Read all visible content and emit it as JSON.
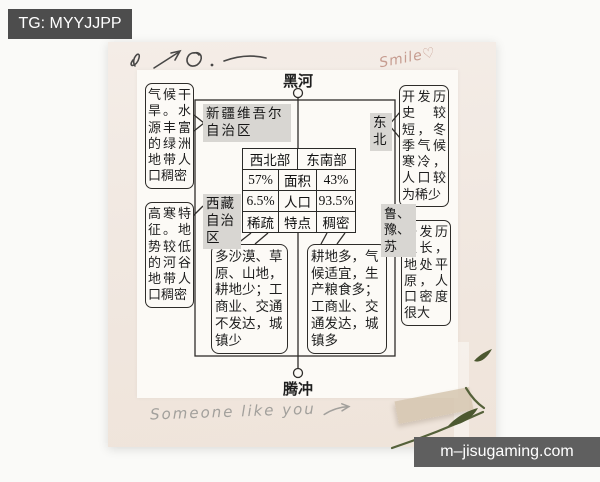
{
  "watermarks": {
    "top_left": "TG: MYYJJPP",
    "bottom_right": "m–jisugaming.com"
  },
  "handwriting": {
    "smile": "Smile♡",
    "someone": "Someone like you"
  },
  "diagram": {
    "top_city": "黑河",
    "bottom_city": "腾冲",
    "regions": {
      "xinjiang": "新疆维吾尔自治区",
      "tibet": "西藏自治区",
      "northeast": "东北",
      "lu_yu_su": "鲁、豫、苏"
    },
    "notes": {
      "xinjiang_note": "气候干旱。水源丰富的绿洲地带人口稠密",
      "tibet_note": "高寒特征。地势较低的河谷地带人口稠密",
      "northeast_note": "开发历史较短，冬季气候寒冷，人口较为稀少",
      "lu_yu_su_note": "开发历史长，地处平原，人口密度很大",
      "northwest_detail": "多沙漠、草原、山地，耕地少；工商业、交通不发达，城镇少",
      "southeast_detail": "耕地多，气候适宜，生产粮食多；工商业、交通发达，城镇多"
    },
    "table": {
      "header": [
        "西北部",
        "东南部"
      ],
      "rows": [
        {
          "nw": "57%",
          "label": "面积",
          "se": "43%"
        },
        {
          "nw": "6.5%",
          "label": "人口",
          "se": "93.5%"
        },
        {
          "nw": "稀疏",
          "label": "特点",
          "se": "稠密"
        }
      ]
    }
  }
}
